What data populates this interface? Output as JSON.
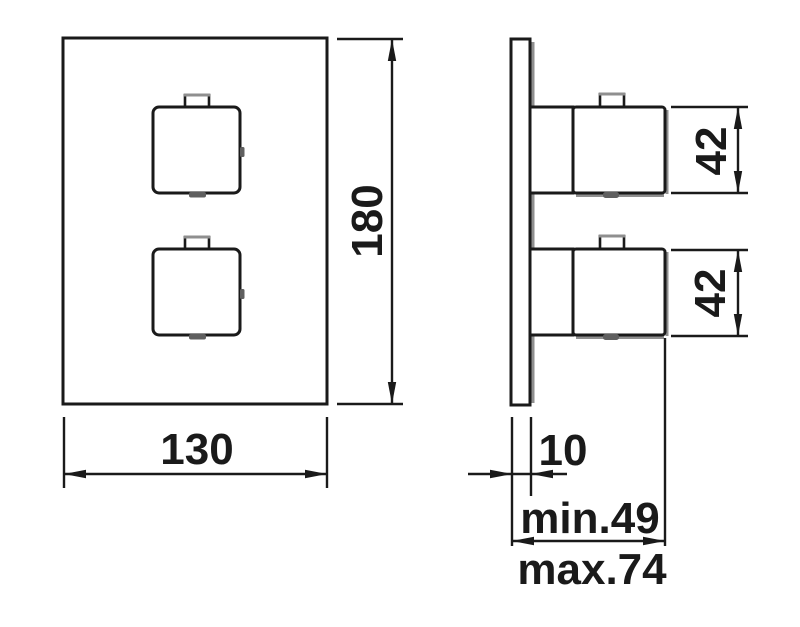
{
  "drawing": {
    "title": "thermostatic-mixer-dimension-drawing",
    "background_color": "#ffffff",
    "line_color": "#1a1a1a",
    "shade_color": "#8f8f8f",
    "views": {
      "front": "front-view-plate-with-two-square-handles",
      "side": "side-view-wall-plate-with-handle-projection"
    },
    "dimensions": {
      "front_width": {
        "label": "130"
      },
      "front_height": {
        "label": "180"
      },
      "handle_top_height": {
        "label": "42"
      },
      "handle_bottom_height": {
        "label": "42"
      },
      "plate_thickness": {
        "label": "10"
      },
      "depth_min": {
        "label": "min.49"
      },
      "depth_max": {
        "label": "max.74"
      }
    }
  }
}
